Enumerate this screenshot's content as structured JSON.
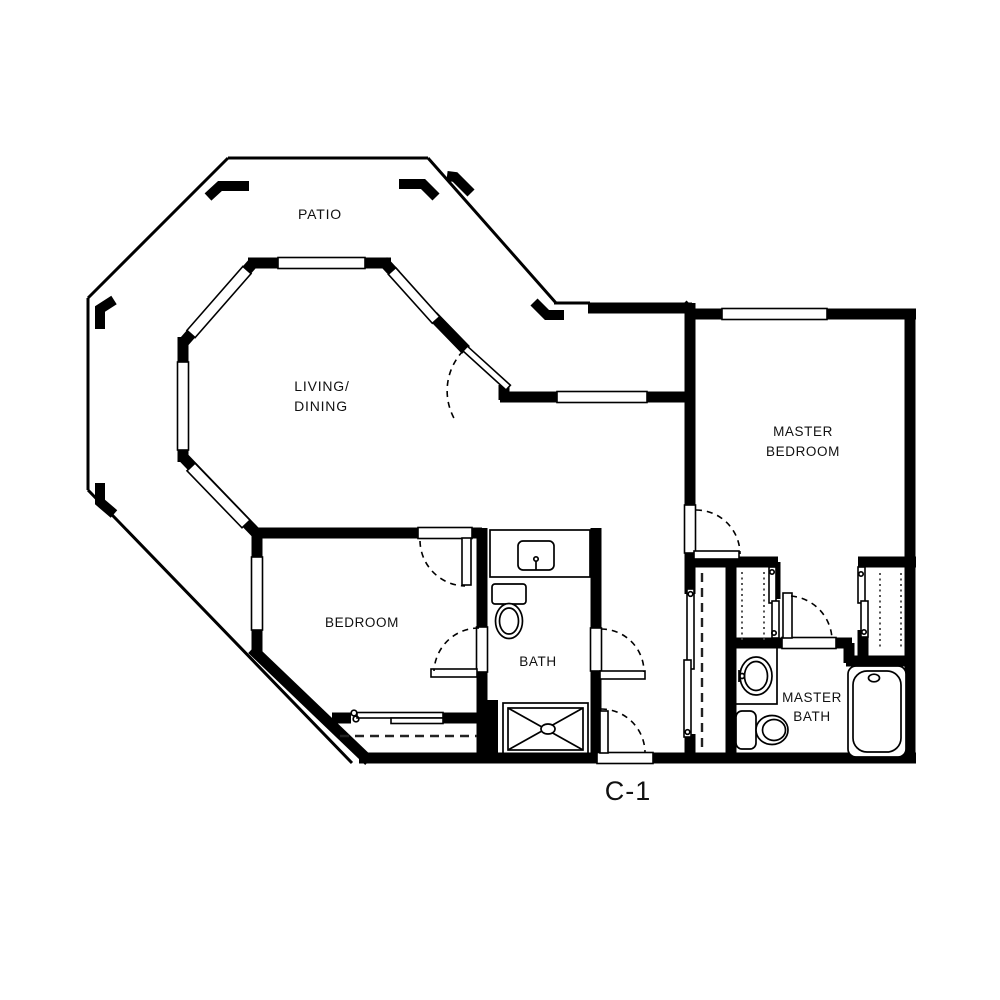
{
  "plan": {
    "title": "C-1",
    "type": "apartment-floor-plan",
    "colors": {
      "walls": "#000000",
      "background": "#ffffff",
      "text": "#111111"
    },
    "rooms": [
      {
        "name": "patio",
        "label": "PATIO"
      },
      {
        "name": "living-dining",
        "label_lines": [
          "LIVING/",
          "DINING"
        ]
      },
      {
        "name": "master-bedroom",
        "label_lines": [
          "MASTER",
          "BEDROOM"
        ]
      },
      {
        "name": "bedroom",
        "label": "BEDROOM"
      },
      {
        "name": "bath",
        "label": "BATH"
      },
      {
        "name": "master-bath",
        "label_lines": [
          "MASTER",
          "BATH"
        ]
      }
    ],
    "fixtures": [
      "bath-vanity-sink",
      "bath-toilet",
      "shower-stall",
      "master-bath-vanity-sink",
      "master-bath-toilet",
      "bathtub",
      "bedroom-sliding-closet",
      "hall-sliding-closet",
      "master-closet-left",
      "master-closet-right",
      "patio-corner-posts",
      "windows",
      "swing-doors",
      "entry-door"
    ]
  }
}
